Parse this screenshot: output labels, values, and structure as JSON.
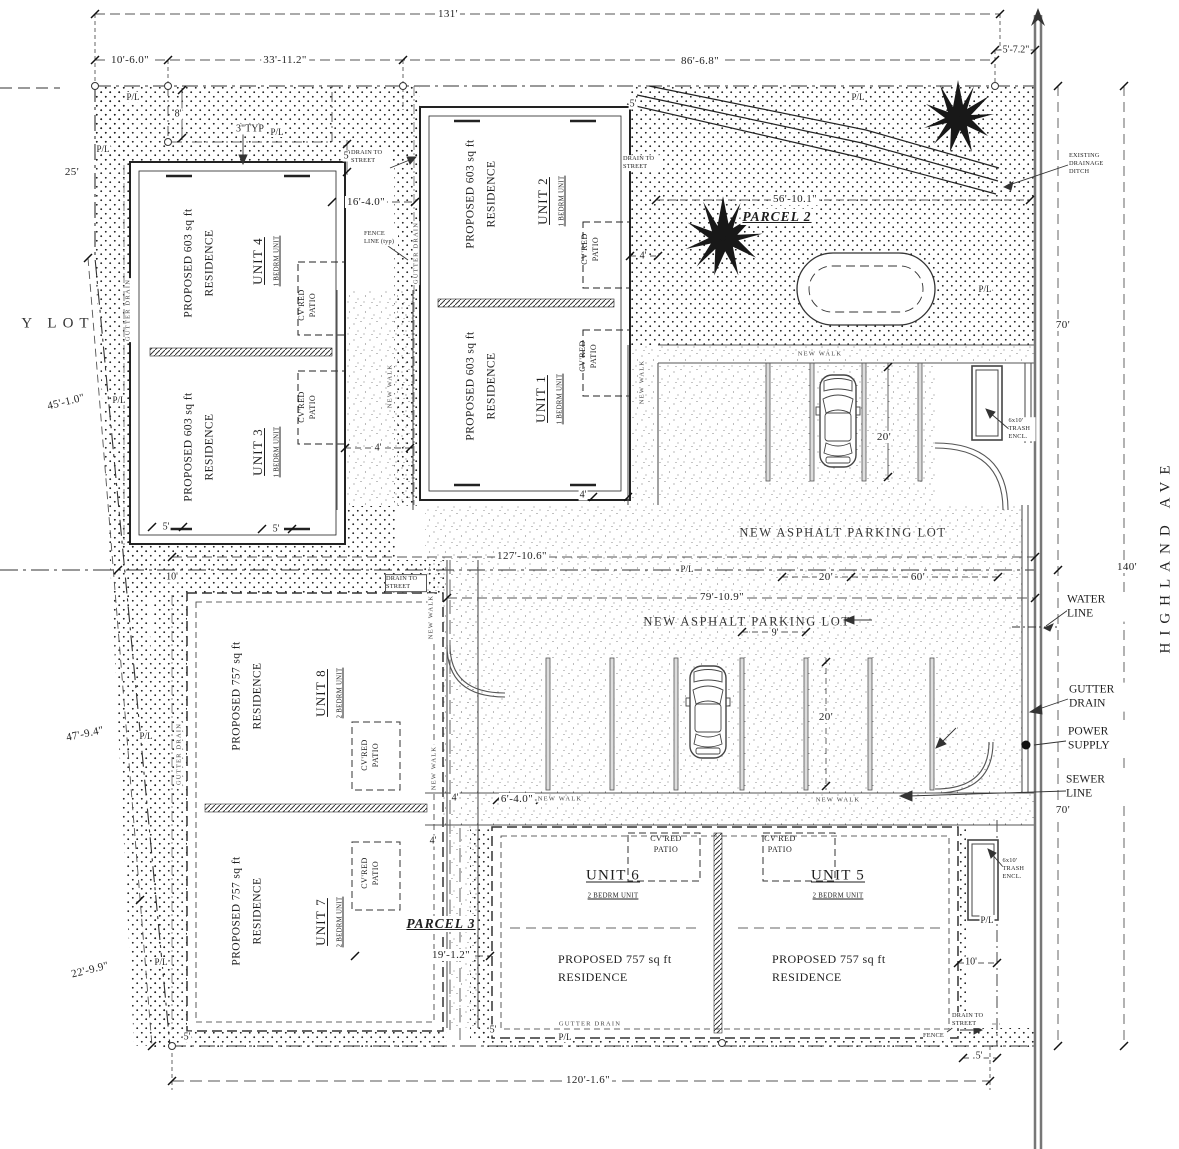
{
  "labels": {
    "pl": "P/L",
    "patio": "CV'RED PATIO",
    "new_walk": "NEW WALK",
    "gutter_drain": "GUTTER DRAIN",
    "drain_to_street": "DRAIN TO STREET",
    "fence_line": "FENCE LINE (typ)",
    "fence": "FENCE",
    "parking_lot": "NEW ASPHALT PARKING LOT",
    "ditch": "EXISTING DRAINAGE DITCH",
    "trash": "6x10' TRASH ENCL.",
    "res603": "PROPOSED 603 sq ft RESIDENCE",
    "res757": "PROPOSED 757 sq ft RESIDENCE",
    "bed1": "1 BEDRM UNIT",
    "bed2": "2 BEDRM UNIT",
    "empty_lot": "Y LOT",
    "parcel2": "PARCEL 2",
    "parcel3": "PARCEL 3",
    "street": "HIGHLAND AVE",
    "water": "WATER LINE",
    "power": "POWER SUPPLY",
    "sewer": "SEWER LINE"
  },
  "units": {
    "u1": "UNIT 1",
    "u2": "UNIT 2",
    "u3": "UNIT 3",
    "u4": "UNIT 4",
    "u5": "UNIT 5",
    "u6": "UNIT 6",
    "u7": "UNIT 7",
    "u8": "UNIT 8"
  },
  "dims": {
    "d131": "131'",
    "d10_6": "10'-6.0\"",
    "d33_11": "33'-11.2\"",
    "d86_6": "86'-6.8\"",
    "d5_7": "5'-7.2\"",
    "d25": "25'",
    "d8": "8'",
    "d3typ": "3\"TYP",
    "d45_1": "45'-1.0\"",
    "d47_9": "47'-9.4\"",
    "d22_9": "22'-9.9\"",
    "d16_4": "16'-4.0\"",
    "d56_10": "56'-10.1\"",
    "d127_10": "127'-10.6\"",
    "d79_10": "79'-10.9\"",
    "d120_1": "120'-1.6\"",
    "d19_1": "19'-1.2\"",
    "d6_4": "6'-4.0\"",
    "d140": "140'",
    "d70": "70'",
    "d60": "60'",
    "d20": "20'",
    "d10": "10'",
    "d9": "9'",
    "d5": "5'",
    "d4": "4'"
  }
}
